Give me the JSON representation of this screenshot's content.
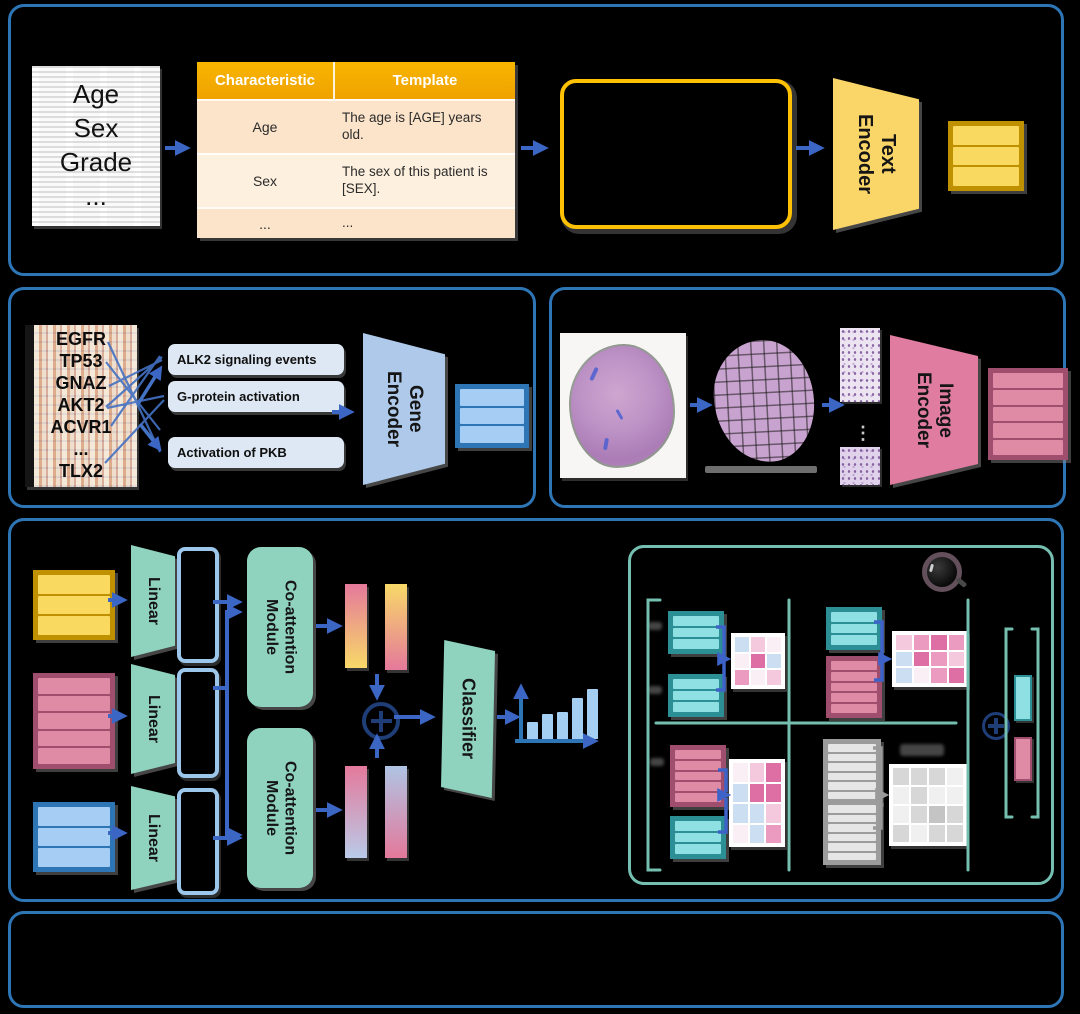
{
  "colors": {
    "panel_border": "#2E75B6",
    "arrow_blue": "#3B66C4",
    "mint_green": "#8FD3BE",
    "yellow_fill": "#FAD961",
    "yellow_border": "#BF9000",
    "pink_fill": "#E08BA6",
    "pink_border": "#A04E6E",
    "blue_fill": "#A6CDF3",
    "blue_border": "#2E75B6",
    "teal_fill": "#8EE0E3",
    "teal_border": "#2D8F96",
    "gray_fill": "#E6E6E6",
    "gray_border": "#9C9C9C",
    "table_header": "#F2A900",
    "prompt_border": "#FFC103",
    "detail_border": "#74BFB0"
  },
  "clinical": {
    "document_lines": [
      "Age",
      "Sex",
      "Grade",
      "..."
    ],
    "table": {
      "headers": [
        "Characteristic",
        "Template"
      ],
      "rows": [
        {
          "characteristic": "Age",
          "template": "The age is [AGE] years old."
        },
        {
          "characteristic": "Sex",
          "template": "The sex of this patient is [SEX]."
        },
        {
          "characteristic": "...",
          "template": "..."
        }
      ]
    },
    "encoder": [
      "Text",
      "Encoder"
    ]
  },
  "gene": {
    "genes": [
      "EGFR",
      "TP53",
      "GNAZ",
      "AKT2",
      "ACVR1",
      "...",
      "TLX2"
    ],
    "pathways": [
      "ALK2 signaling events",
      "G-protein activation",
      "Activation of PKB"
    ],
    "encoder": [
      "Gene",
      "Encoder"
    ]
  },
  "histology": {
    "encoder": [
      "Image",
      "Encoder"
    ],
    "patch_ellipsis": "⋮"
  },
  "fusion": {
    "linear_labels": [
      "Linear",
      "Linear",
      "Linear"
    ],
    "coattention_modules": [
      [
        "Co-attention",
        "Module"
      ],
      [
        "Co-attention",
        "Module"
      ]
    ],
    "classifier": "Classifier",
    "chart": {
      "type": "bar",
      "values": [
        17,
        25,
        27,
        41,
        50
      ]
    }
  },
  "detail": {
    "palette": {
      "w": "#FAEFF5",
      "l": "#F4C9DD",
      "p": "#EC9BC0",
      "P": "#DE6FA4",
      "b": "#CCDFF2",
      "g1": "#F0F0F0",
      "g2": "#D7D7D7",
      "g3": "#C4C4C4"
    },
    "heatmaps": {
      "q1": [
        [
          "b",
          "l",
          "w"
        ],
        [
          "w",
          "P",
          "b"
        ],
        [
          "p",
          "w",
          "l"
        ]
      ],
      "q2": [
        [
          "l",
          "p",
          "P",
          "p"
        ],
        [
          "b",
          "P",
          "p",
          "l"
        ],
        [
          "b",
          "w",
          "p",
          "P"
        ]
      ],
      "q3": [
        [
          "w",
          "l",
          "P"
        ],
        [
          "b",
          "P",
          "P"
        ],
        [
          "b",
          "b",
          "l"
        ],
        [
          "w",
          "b",
          "p"
        ]
      ],
      "q4": [
        [
          "g2",
          "g2",
          "g2",
          "g1"
        ],
        [
          "g1",
          "g2",
          "g1",
          "g1"
        ],
        [
          "g1",
          "g2",
          "g3",
          "g2"
        ],
        [
          "g2",
          "g1",
          "g2",
          "g2"
        ]
      ]
    }
  }
}
